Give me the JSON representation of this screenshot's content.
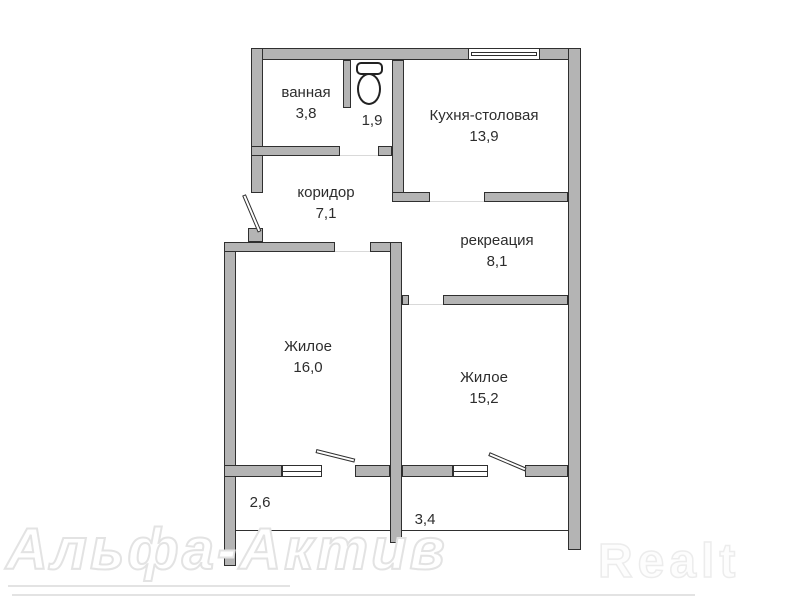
{
  "rooms": {
    "bathroom": {
      "label": "ванная",
      "area": "3,8"
    },
    "toilet": {
      "area": "1,9"
    },
    "kitchen": {
      "label": "Кухня-столовая",
      "area": "13,9"
    },
    "corridor": {
      "label": "коридор",
      "area": "7,1"
    },
    "recreation": {
      "label": "рекреация",
      "area": "8,1"
    },
    "living1": {
      "label": "Жилое",
      "area": "16,0"
    },
    "living2": {
      "label": "Жилое",
      "area": "15,2"
    },
    "balcony1": {
      "area": "2,6"
    },
    "balcony2": {
      "area": "3,4"
    }
  },
  "watermarks": {
    "agency": "Альфа-Актив",
    "portal": "Realt"
  },
  "colors": {
    "wall_fill": "#b4b4b4",
    "wall_outline": "#2f2f2f",
    "label_text": "#2d2d2d",
    "watermark": "#e3e3e3",
    "background": "#ffffff"
  }
}
